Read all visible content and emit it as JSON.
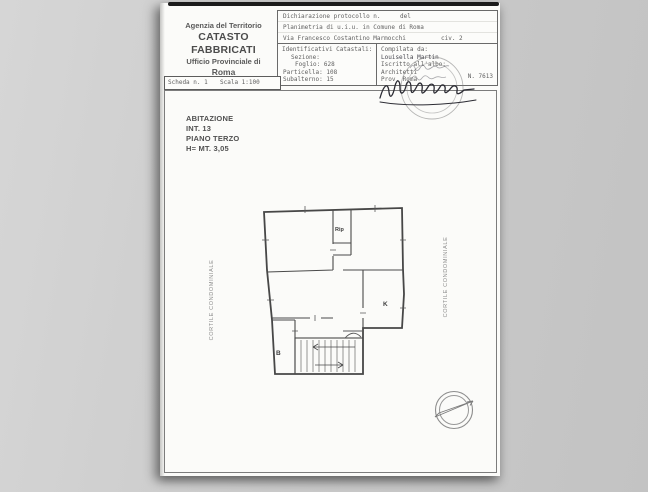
{
  "colors": {
    "background": "#c9c9c9",
    "paper": "#fbfbf9",
    "print_ink": "#5f5f5f",
    "drawing_ink": "#474747",
    "stamp_gray": "#9a9a9a",
    "signature_ink": "#2b2b33"
  },
  "agency": {
    "line1": "Agenzia del Territorio",
    "line2": "CATASTO FABBRICATI",
    "line3": "Ufficio Provinciale di",
    "line4": "Roma"
  },
  "declaration": {
    "protocol_label": "Dichiarazione protocollo n.",
    "protocol_del": "del",
    "planimetria": "Planimetria di u.i.u. in Comune di Roma",
    "street": "Via Francesco Costantino Marmocchi",
    "civic": "civ. 2"
  },
  "catastali": {
    "title": "Identificativi Catastali:",
    "rows": [
      {
        "label": "Sezione:",
        "value": ""
      },
      {
        "label": "Foglio:",
        "value": "628"
      },
      {
        "label": "Particella:",
        "value": "108"
      },
      {
        "label": "Subalterno:",
        "value": "15"
      }
    ]
  },
  "compiler": {
    "compiled_by": "Compilata da:",
    "name": "Louisella Martin",
    "registered": "Iscritto all'albo:",
    "order": "Architetti",
    "province": "Prov. Roma",
    "number": "N. 7613"
  },
  "scheda": {
    "sheet": "Scheda n. 1",
    "scale": "Scala 1:100"
  },
  "dwelling": {
    "line1": "ABITAZIONE",
    "line2": "INT. 13",
    "line3": "PIANO TERZO",
    "line4": "H= MT. 3,05"
  },
  "plan": {
    "courtyard_left": "CORTILE CONDOMINIALE",
    "courtyard_right": "CORTILE CONDOMINIALE",
    "rooms": {
      "storage": "Rip",
      "kitchen": "K",
      "bathroom": "B"
    }
  }
}
